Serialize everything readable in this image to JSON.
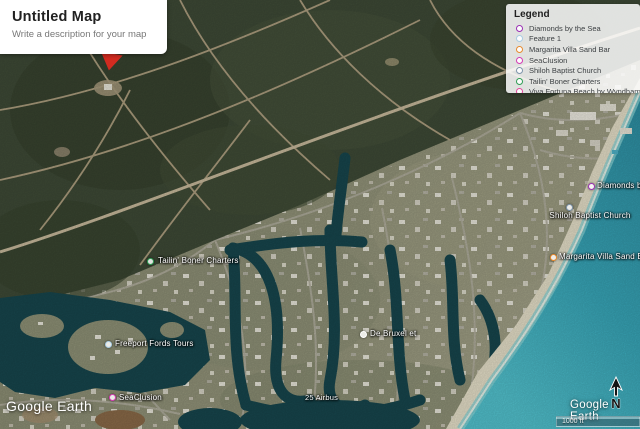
{
  "map_card": {
    "title": "Untitled Map",
    "subtitle": "Write a description for your map"
  },
  "legend": {
    "title": "Legend",
    "items": [
      {
        "label": "Diamonds by the Sea",
        "color": "#9B30B5"
      },
      {
        "label": "Feature 1",
        "color": "#A9CCE3"
      },
      {
        "label": "Margarita Villa Sand Bar",
        "color": "#E8892B"
      },
      {
        "label": "SeaClusion",
        "color": "#D53AB4"
      },
      {
        "label": "Shiloh Baptist Church",
        "color": "#7E95AB"
      },
      {
        "label": "Tailin' Boner Charters",
        "color": "#2F9E54"
      },
      {
        "label": "Viva Fortuna Beach by Wyndham, A?",
        "color": "#E2479B"
      }
    ]
  },
  "map_labels": [
    {
      "text": "Tailin' Boner Charters",
      "color": "#2F9E54"
    },
    {
      "text": "Freeport Fords Tours",
      "color": "#A9CCE3"
    },
    {
      "text": "SeaClusion",
      "color": "#D53AB4"
    },
    {
      "text": "Diamonds by the Sea",
      "color": "#9B30B5"
    },
    {
      "text": "Shiloh Baptist Church",
      "color": "#7E95AB"
    },
    {
      "text": "Margarita Villa Sand Bar",
      "color": "#E8892B"
    },
    {
      "text": "De Bruxel et",
      "color": "#FFFFFF"
    },
    {
      "text": "25 Airbus",
      "color": ""
    }
  ],
  "watermarks": {
    "bottom_left": "Google Earth",
    "bottom_right": "Google Earth"
  },
  "scale_bar": {
    "label": "1000 ft"
  },
  "compass": {
    "letter": "N"
  },
  "annotation": {
    "shape": "red-arrow-down",
    "color": "#D22B20"
  }
}
